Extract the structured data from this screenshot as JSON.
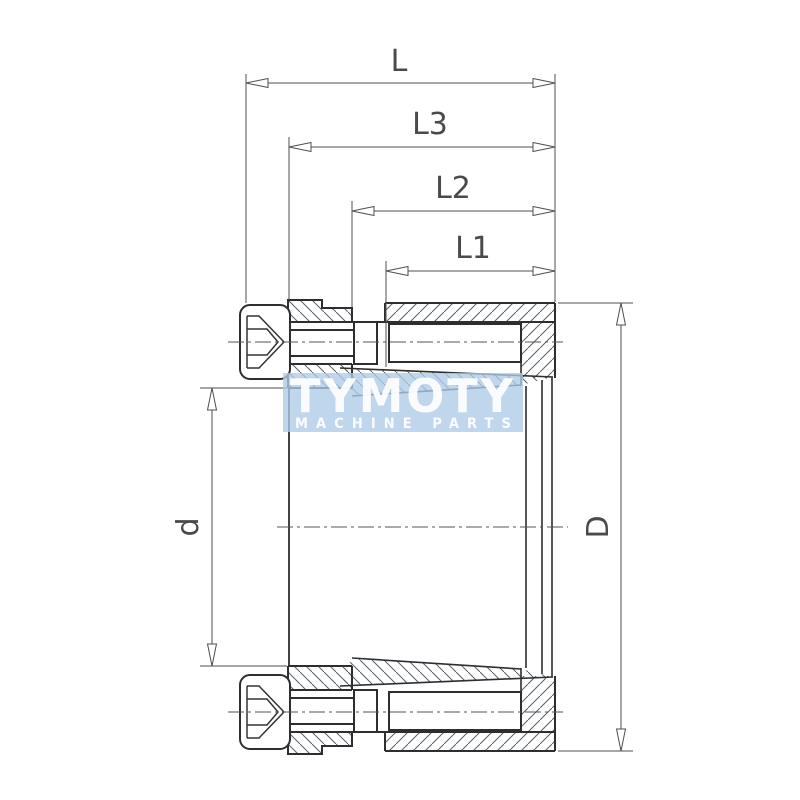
{
  "diagram": {
    "background": "#ffffff",
    "line_color": "#3a3a3a",
    "dims": {
      "L": {
        "label": "L"
      },
      "L3": {
        "label": "L3"
      },
      "L2": {
        "label": "L2"
      },
      "L1": {
        "label": "L1"
      },
      "d": {
        "label": "d"
      },
      "D": {
        "label": "D"
      }
    },
    "watermark": {
      "brand": "TYMOTY",
      "tagline": "MACHINE PARTS",
      "panel_color": "#aecbe8",
      "text_color": "#ffffff"
    }
  }
}
